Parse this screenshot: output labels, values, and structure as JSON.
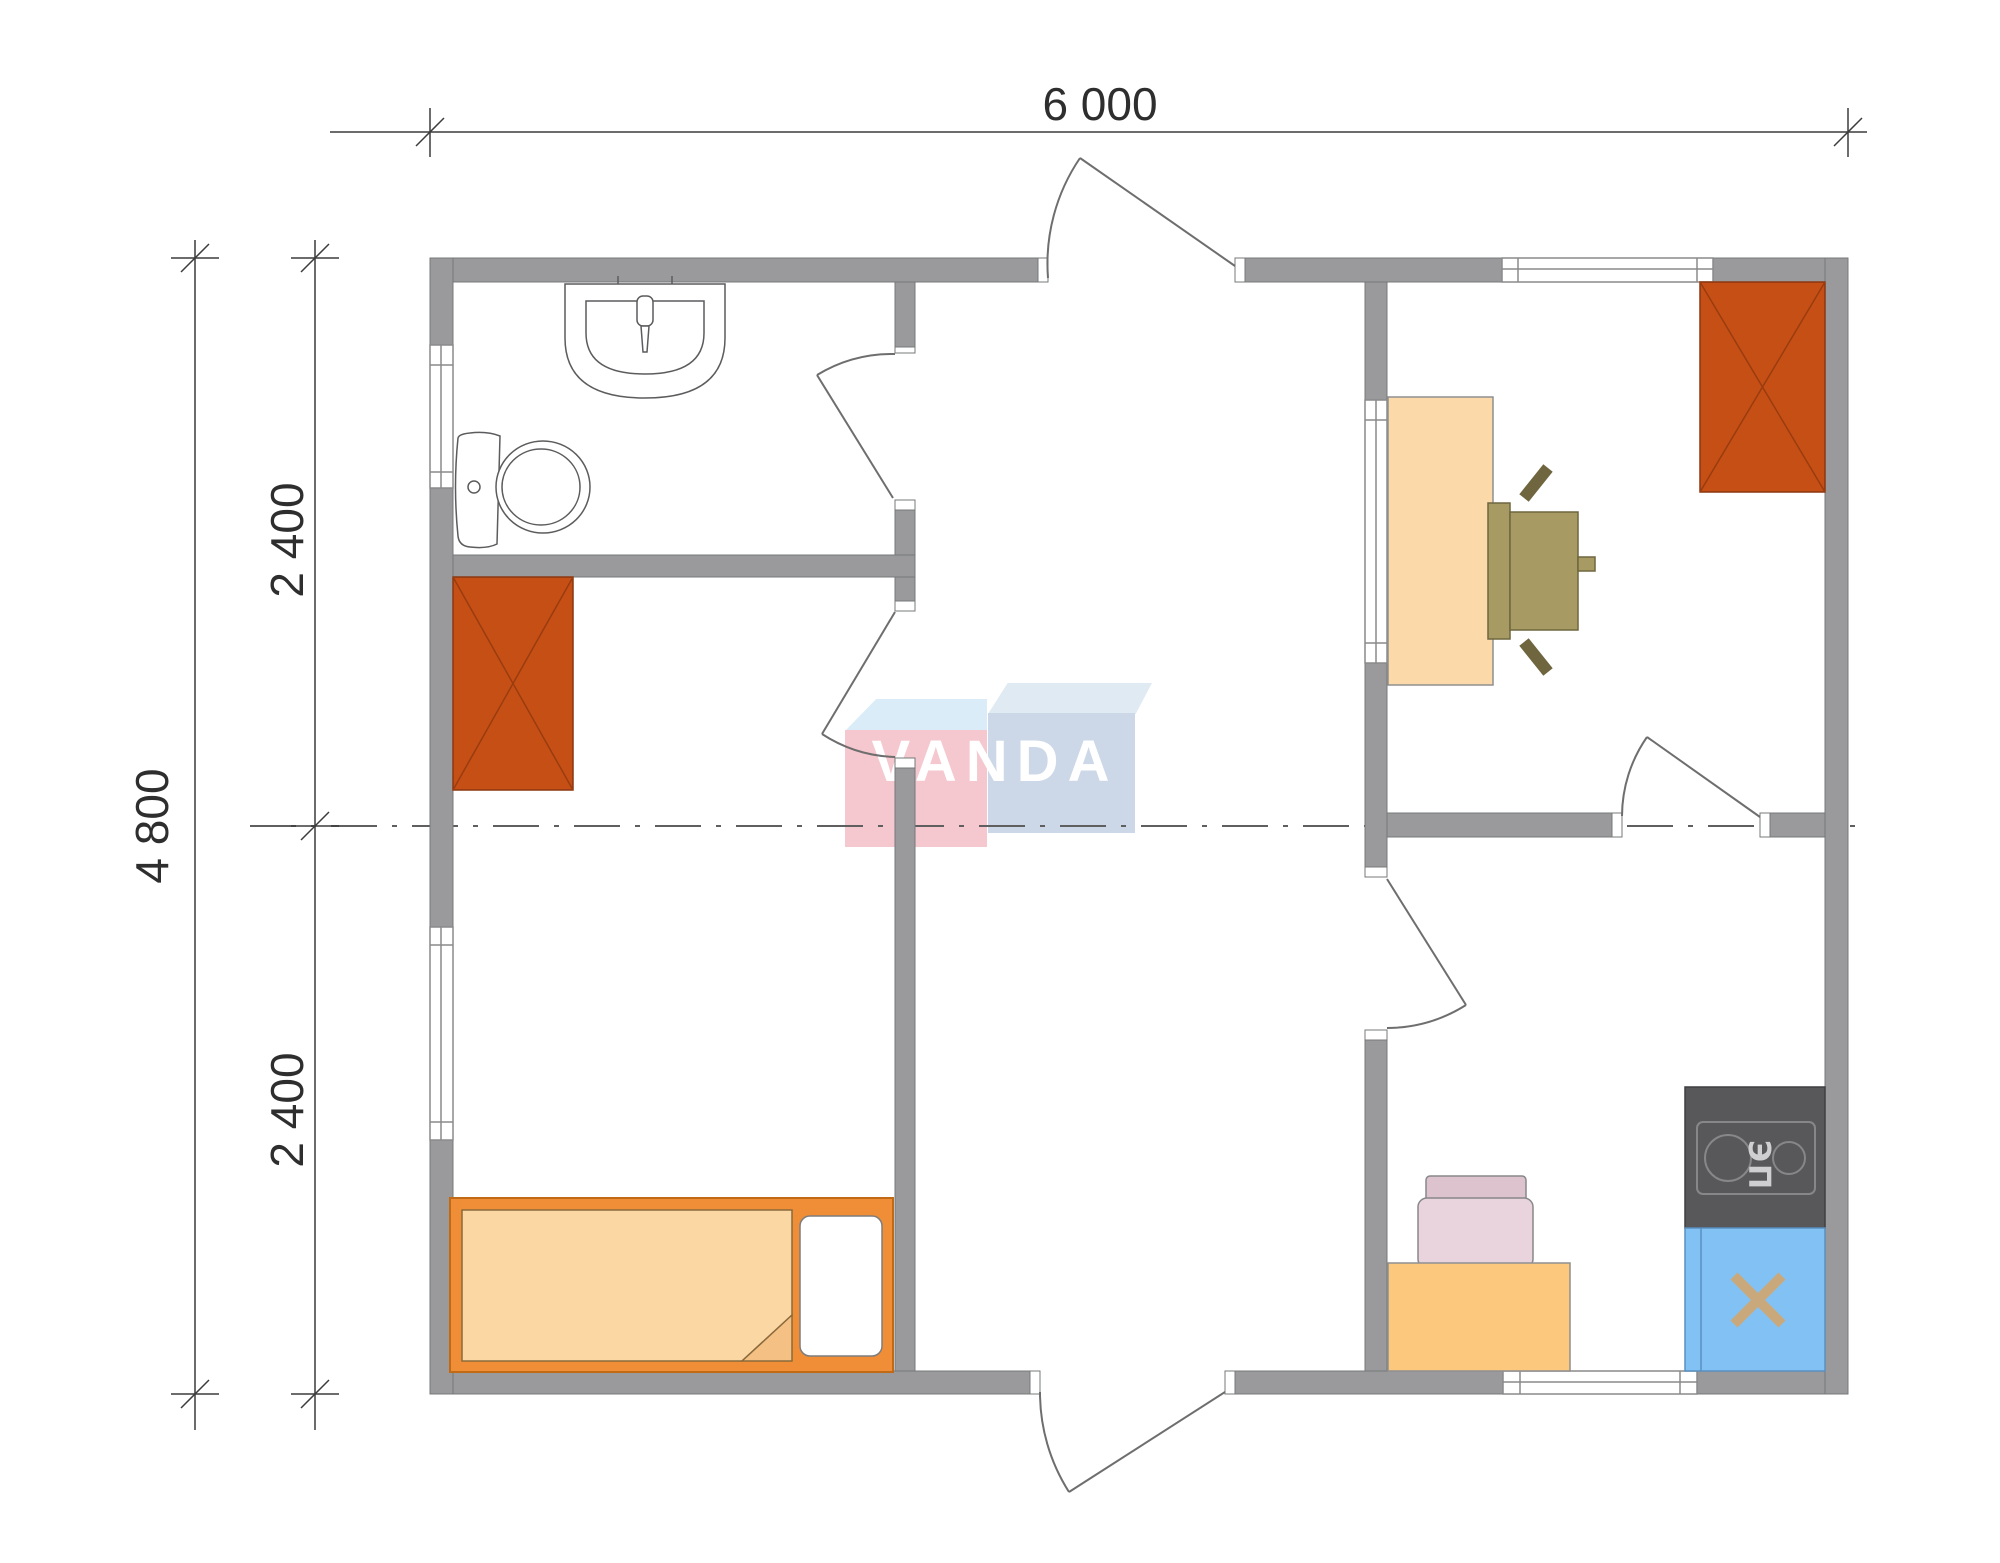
{
  "dimensions": {
    "top_width": "6 000",
    "left_total": "4 800",
    "left_upper": "2 400",
    "left_lower": "2 400"
  },
  "watermark": {
    "text": "VANDA"
  },
  "kitchen": {
    "stove_label": "ЭП"
  },
  "furniture_icons": [
    "sink-icon",
    "toilet-icon",
    "wardrobe-icon",
    "bed-icon",
    "pillow-icon",
    "desk-icon",
    "office-chair-icon",
    "kitchen-table-icon",
    "kitchen-chair-icon",
    "stove-icon",
    "kitchen-sink-icon",
    "door-swing-icon",
    "window-icon"
  ],
  "colors": {
    "wall": "#9a9a9c",
    "wall_edge": "#77787a",
    "wardrobe": "#c64f15",
    "bed_frame": "#ef8e36",
    "blanket": "#fbd7a4",
    "desk": "#fbd9a8",
    "office_chair": "#a79b63",
    "kitchen_table": "#fbc87d",
    "kitchen_chair": "#e9d3dd",
    "stove": "#58585a",
    "kitchen_sink": "#82c1f4",
    "faucet_cross": "#c9a97c",
    "logo_pink": "#f5c7ce",
    "logo_blue": "#ccd8e8",
    "logo_flap_left": "#d9ecf8",
    "logo_flap_right": "#dfeaf3",
    "dimension_line": "#3c3c3c"
  }
}
